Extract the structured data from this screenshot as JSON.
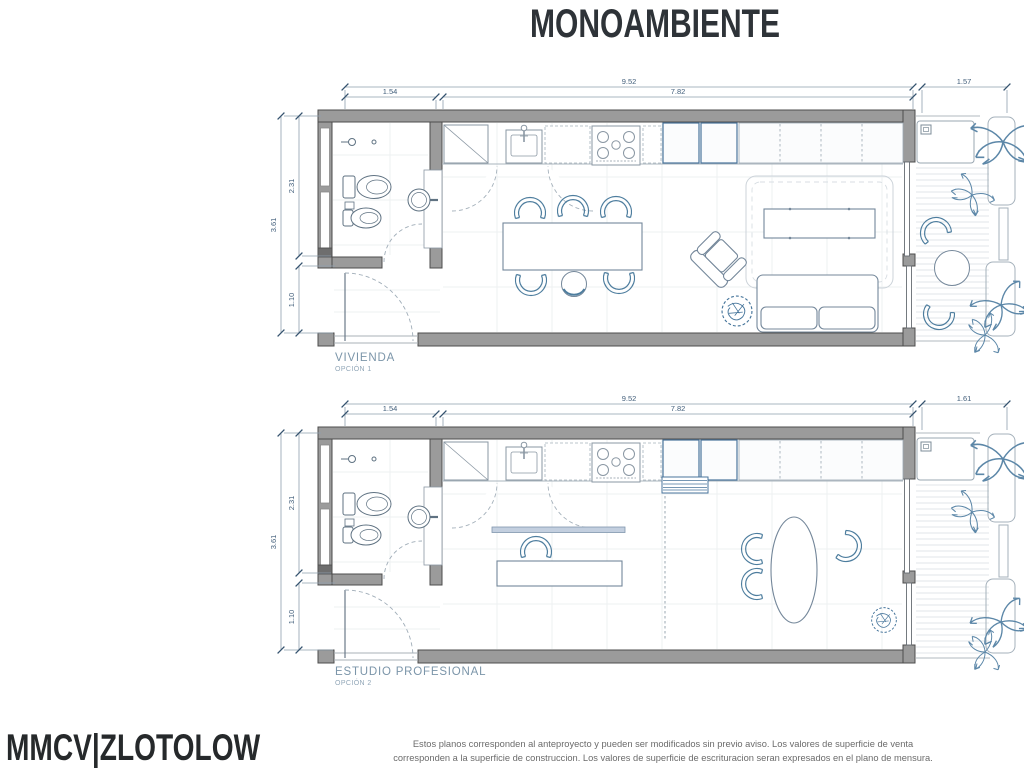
{
  "title": "MONOAMBIENTE",
  "logo": "MMCV|ZLOTOLOW",
  "disclaimer": {
    "line1": "Estos planos corresponden al anteproyecto y pueden ser modificados sin previo aviso. Los valores de superficie de venta",
    "line2": "corresponden a la superficie de construccion. Los valores de superficie de escrituracion seran expresados en el plano de mensura."
  },
  "plans": [
    {
      "label": "VIVIENDA",
      "option": "OPCIÓN 1",
      "dims": {
        "total": "9.52",
        "left": "1.54",
        "main": "7.82",
        "balcony": "1.57",
        "depth_total": "3.61",
        "depth_upper": "2.31",
        "depth_lower": "1.10"
      }
    },
    {
      "label": "ESTUDIO PROFESIONAL",
      "option": "OPCIÓN 2",
      "dims": {
        "total": "9.52",
        "left": "1.54",
        "main": "7.82",
        "balcony": "1.61",
        "depth_total": "3.61",
        "depth_upper": "2.31",
        "depth_lower": "1.10"
      }
    }
  ],
  "colors": {
    "wall_fill": "#9b9b9b",
    "wall_edge": "#4c4c4c",
    "furniture": "#74879a",
    "accent_chair": "#4d7d9e",
    "accent_blue": "#49759c",
    "dim_line": "#8fa0af",
    "dim_text": "#44607c",
    "label_text": "#7b95a9",
    "foliage": "#5c87a8"
  }
}
